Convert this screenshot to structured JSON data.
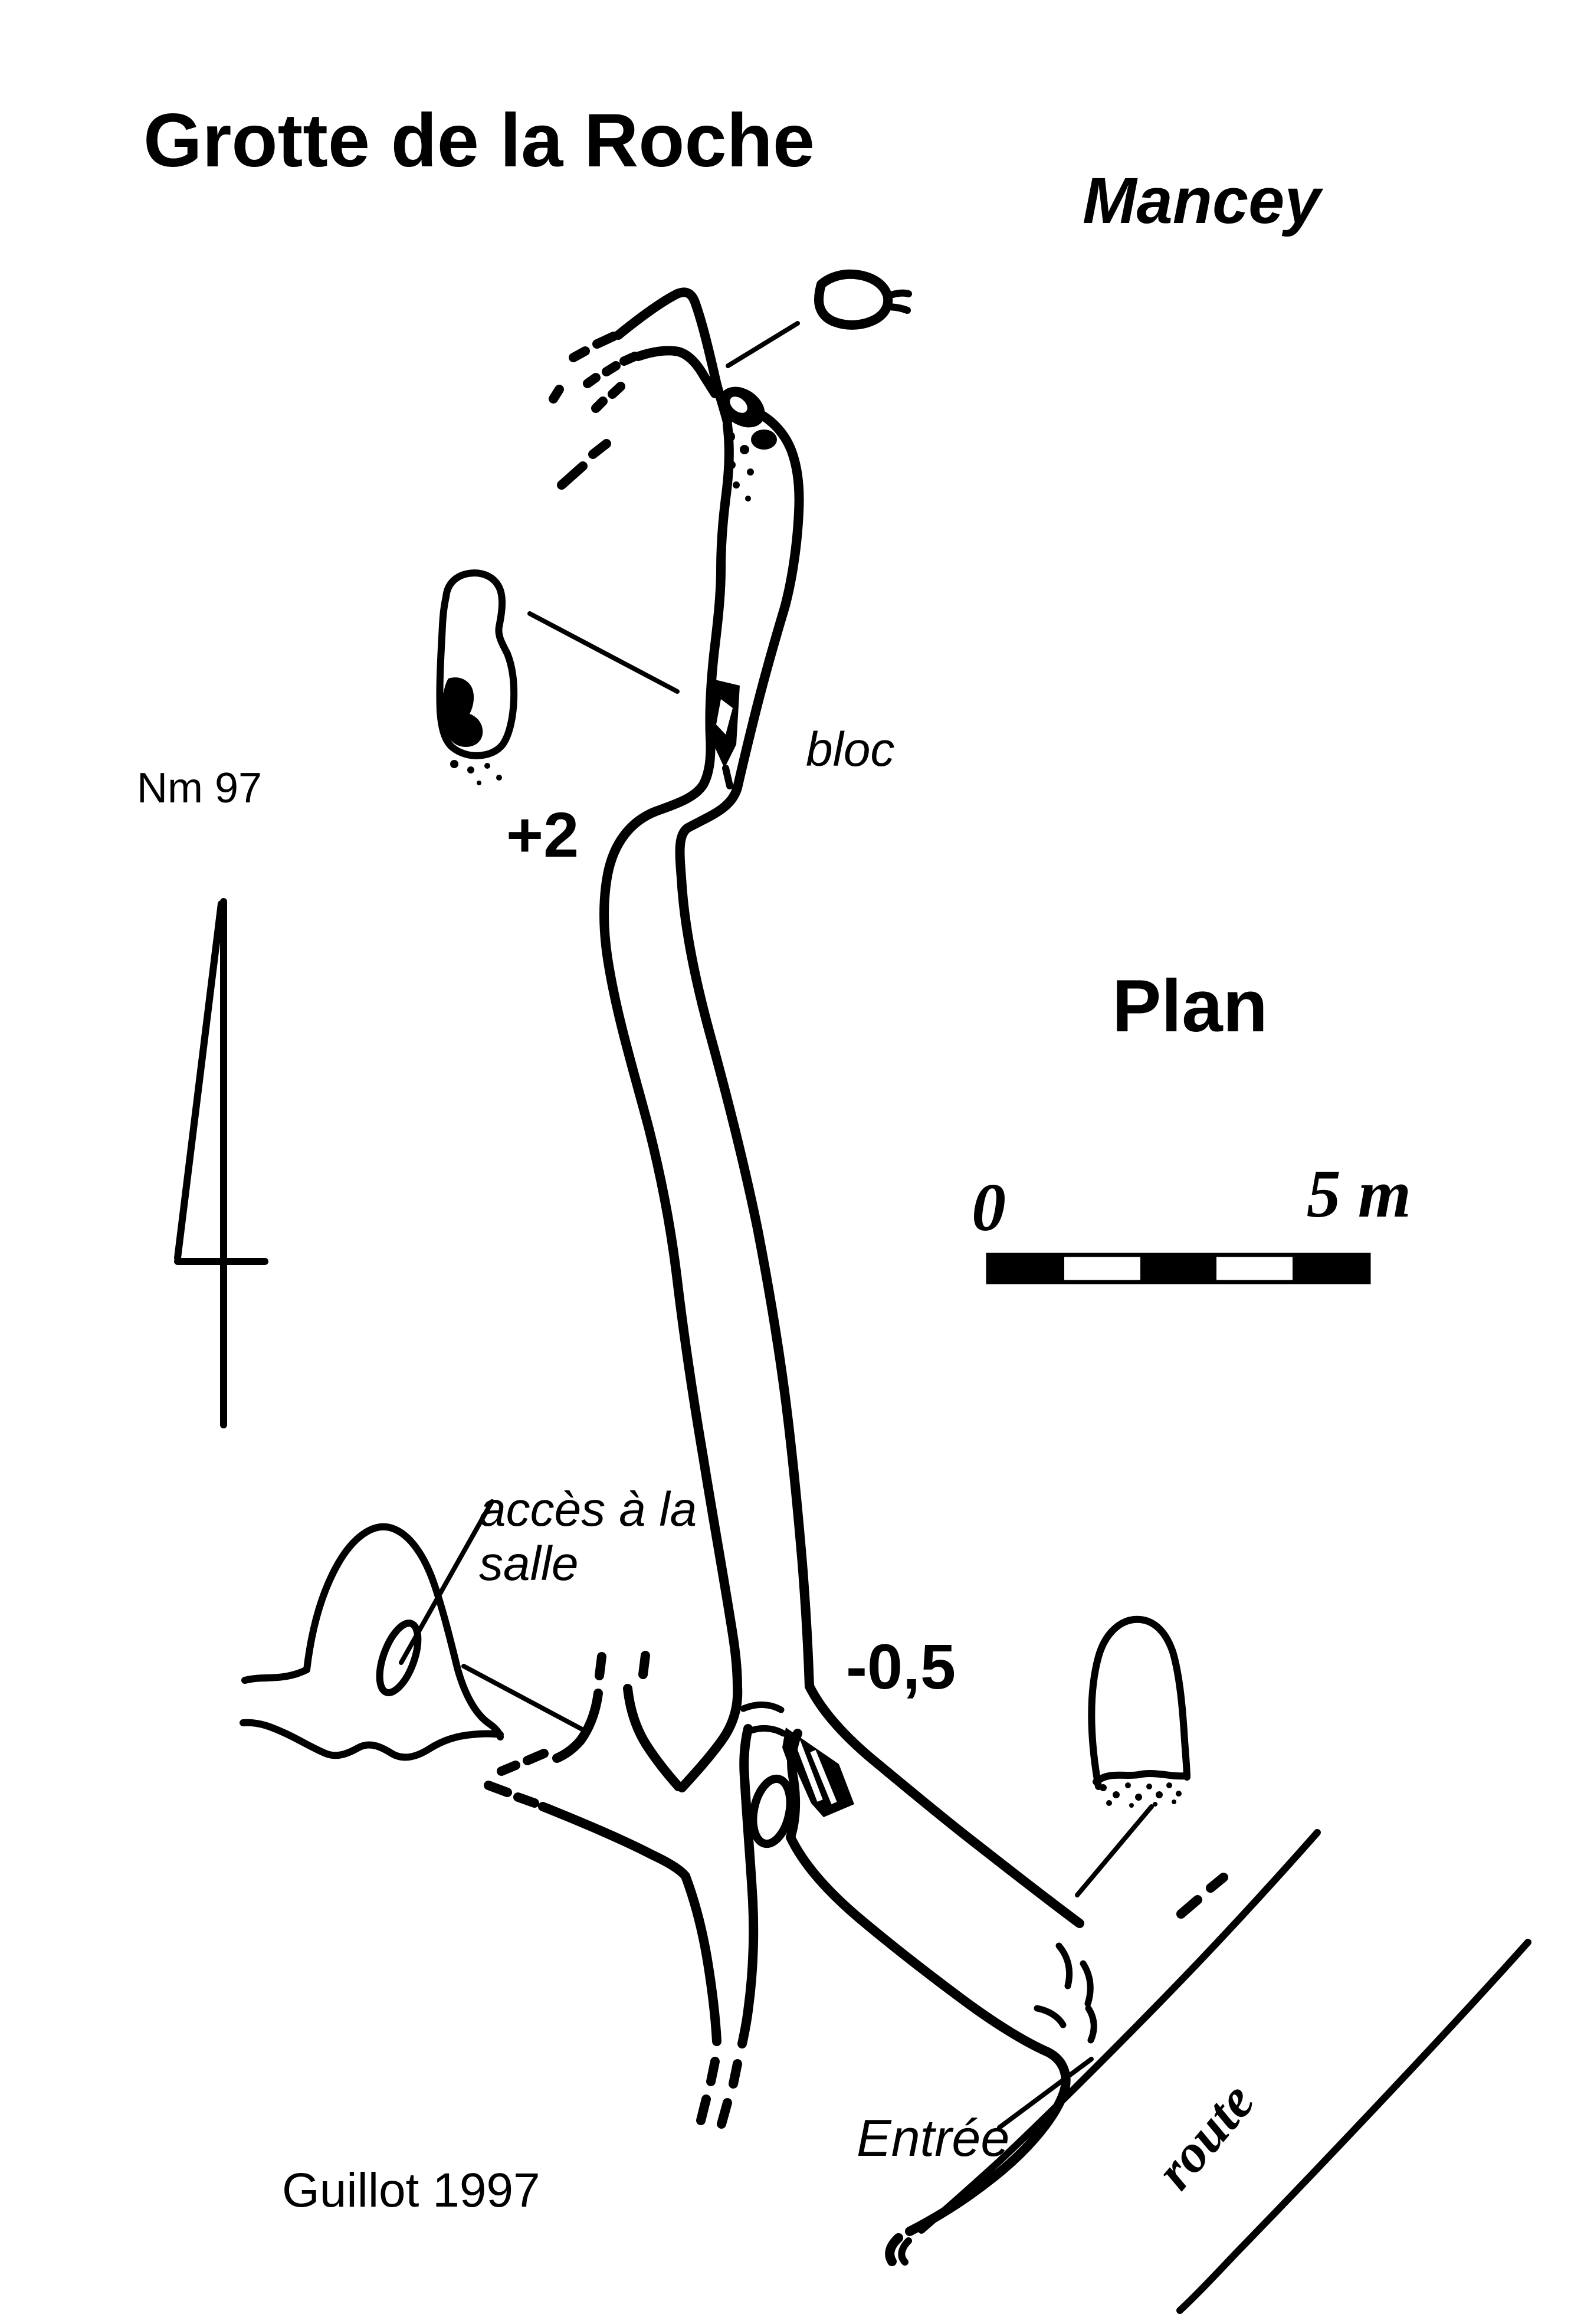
{
  "page": {
    "background": "#ffffff",
    "ink": "#000000"
  },
  "header": {
    "title": "Grotte de la Roche",
    "commune": "Mancey"
  },
  "map": {
    "view_label": "Plan",
    "credit": "Guillot 1997",
    "north_arrow": {
      "label": "Nm 97"
    },
    "scale_bar": {
      "zero_label": "0",
      "end_label": "5 m",
      "segments": [
        "black",
        "white",
        "black",
        "white",
        "black"
      ],
      "length_meters": 5
    },
    "elevation_labels": {
      "upper_gallery": "+2",
      "near_entrance": "-0,5"
    },
    "feature_labels": {
      "bloc": "bloc",
      "acces_line1": "accès à la",
      "acces_line2": "salle",
      "entrance": "Entrée",
      "road": "route"
    }
  }
}
